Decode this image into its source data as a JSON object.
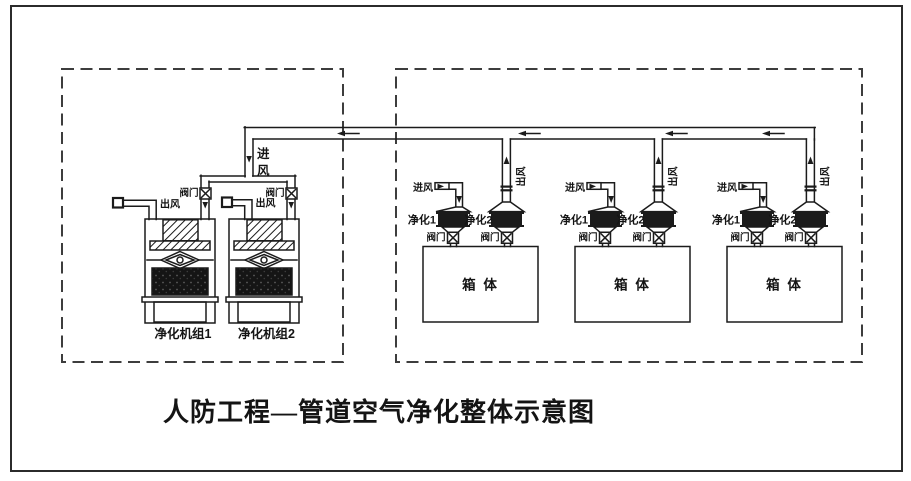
{
  "diagram": {
    "title": "人防工程—管道空气净化整体示意图",
    "main_pipe": {
      "intake_chars": [
        "进",
        "风"
      ],
      "flow_direction": "left"
    },
    "left_zone": {
      "units": [
        {
          "name": "净化机组1",
          "outlet_label": "出风",
          "valve_label": "阀门"
        },
        {
          "name": "净化机组2",
          "outlet_label": "出风",
          "valve_label": "阀门"
        }
      ]
    },
    "right_zone": {
      "groups": [
        {
          "inlet_label": "进风",
          "purifier_left": "净化1",
          "purifier_right": "净化2",
          "valve_left": "阀门",
          "valve_right": "阀门",
          "outlet_label": "出风",
          "box_label": "箱 体"
        },
        {
          "inlet_label": "进风",
          "purifier_left": "净化1",
          "purifier_right": "净化2",
          "valve_left": "阀门",
          "valve_right": "阀门",
          "outlet_label": "出风",
          "box_label": "箱 体"
        },
        {
          "inlet_label": "进风",
          "purifier_left": "净化1",
          "purifier_right": "净化2",
          "valve_left": "阀门",
          "valve_right": "阀门",
          "outlet_label": "出风",
          "box_label": "箱 体"
        }
      ]
    },
    "colors": {
      "line": "#1b1b1b",
      "dash_border": "#3d3d3d",
      "background": "#ffffff"
    }
  }
}
